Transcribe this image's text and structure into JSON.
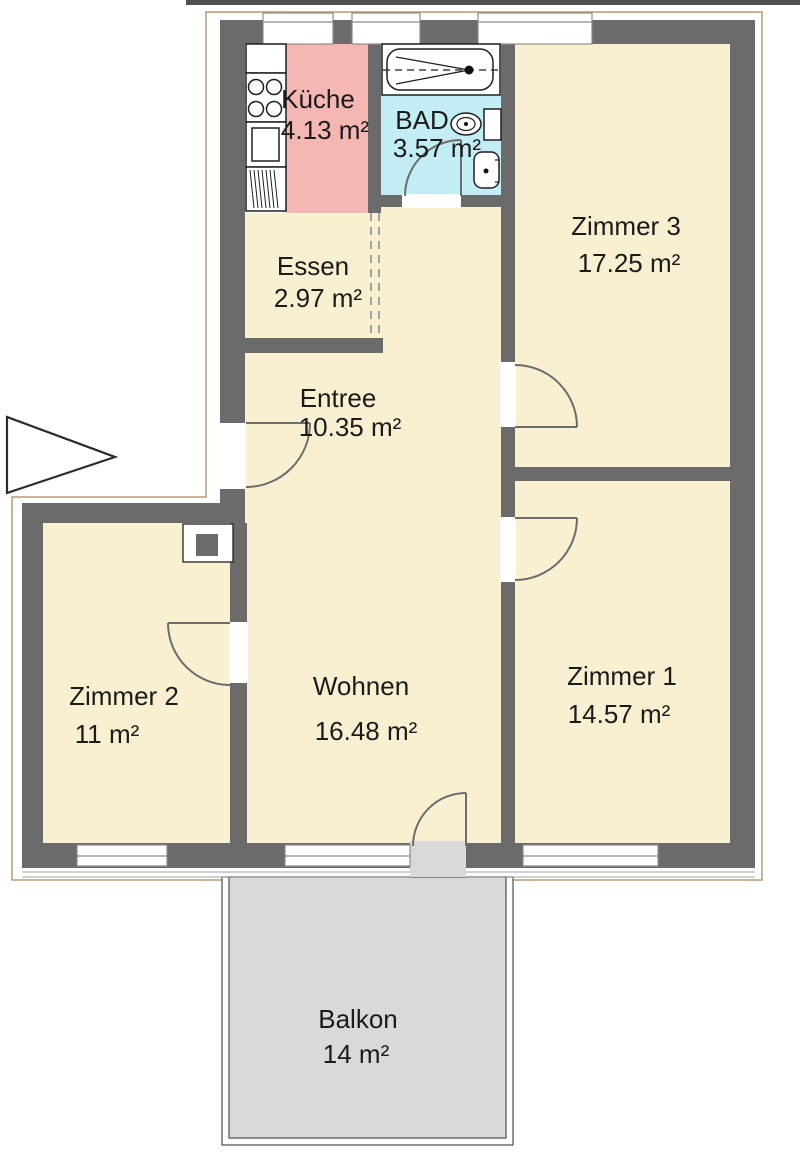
{
  "title": "Wohnungsgrundriss",
  "rooms": {
    "kueche": {
      "name": "Küche",
      "area": "4.13 m²"
    },
    "bad": {
      "name": "BAD",
      "area": "3.57 m²"
    },
    "zimmer3": {
      "name": "Zimmer 3",
      "area": "17.25 m²"
    },
    "essen": {
      "name": "Essen",
      "area": "2.97 m²"
    },
    "entree": {
      "name": "Entree",
      "area": "10.35 m²"
    },
    "zimmer2": {
      "name": "Zimmer 2",
      "area": "11 m²"
    },
    "wohnen": {
      "name": "Wohnen",
      "area": "16.48 m²"
    },
    "zimmer1": {
      "name": "Zimmer 1",
      "area": "14.57 m²"
    },
    "balkon": {
      "name": "Balkon",
      "area": "14 m²"
    }
  },
  "colors": {
    "room": "#f9efd1",
    "kitchen": "#f4b7b3",
    "bath": "#c3edf5",
    "balcony": "#d9d9d9",
    "wall": "#6b6b6b",
    "outline": "#b59a72",
    "door": "#6d6d6d",
    "window_frame": "#8c8c8c",
    "text": "#1b1b1b"
  },
  "icons": {
    "entrance_arrow": "right-pointing-triangle",
    "fixtures": [
      "stove",
      "kitchen-sink",
      "dishwasher",
      "bathtub",
      "toilet",
      "washbasin",
      "duct"
    ]
  }
}
